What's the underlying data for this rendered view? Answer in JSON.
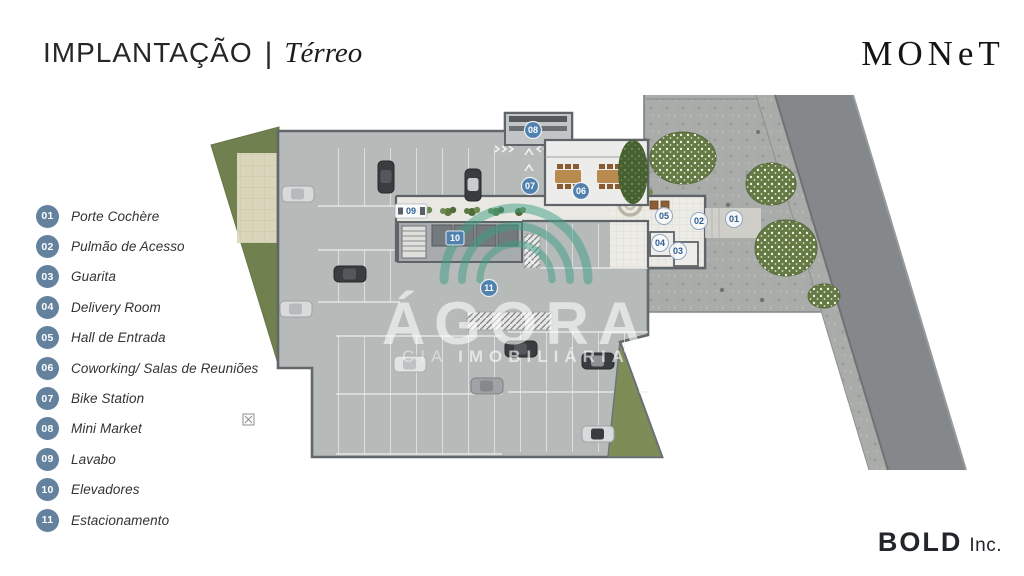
{
  "header": {
    "title": "IMPLANTAÇÃO",
    "separator": "|",
    "subtitle": "Térreo"
  },
  "brand": {
    "name": "MONeT"
  },
  "publisher": {
    "name": "BOLD",
    "suffix": "Inc."
  },
  "watermark": {
    "word": "ÁGORA",
    "tagline_thin": "CIA",
    "tagline_bold": "IMOBILIÁRIA",
    "arch_color": "#3da084"
  },
  "colors": {
    "legend_badge_blue": "#64829e",
    "marker_blue": "#5181ae",
    "marker_text_blue": "#2e6093",
    "green_dark": "#71804f",
    "green_light": "#7e8c58",
    "garage_floor": "#b6bab9",
    "wall_gray": "#60656a",
    "stone_plaza": "#a9aca9",
    "road_gray": "#85888b"
  },
  "legend": {
    "items": [
      {
        "num": "01",
        "label": "Porte Cochère"
      },
      {
        "num": "02",
        "label": "Pulmão de Acesso"
      },
      {
        "num": "03",
        "label": "Guarita"
      },
      {
        "num": "04",
        "label": "Delivery Room"
      },
      {
        "num": "05",
        "label": "Hall de Entrada"
      },
      {
        "num": "06",
        "label": "Coworking/ Salas de Reuniões"
      },
      {
        "num": "07",
        "label": "Bike Station"
      },
      {
        "num": "08",
        "label": "Mini Market"
      },
      {
        "num": "09",
        "label": "Lavabo"
      },
      {
        "num": "10",
        "label": "Elevadores"
      },
      {
        "num": "11",
        "label": "Estacionamento"
      }
    ]
  },
  "plan": {
    "markers": [
      {
        "num": "08",
        "x": 533,
        "y": 130,
        "variant": "blue"
      },
      {
        "num": "07",
        "x": 530,
        "y": 186,
        "variant": "blue"
      },
      {
        "num": "06",
        "x": 581,
        "y": 191,
        "variant": "blue"
      },
      {
        "num": "05",
        "x": 664,
        "y": 216,
        "variant": "light"
      },
      {
        "num": "02",
        "x": 699,
        "y": 221,
        "variant": "light"
      },
      {
        "num": "01",
        "x": 734,
        "y": 219,
        "variant": "light"
      },
      {
        "num": "04",
        "x": 660,
        "y": 243,
        "variant": "light"
      },
      {
        "num": "03",
        "x": 678,
        "y": 251,
        "variant": "light"
      },
      {
        "num": "09",
        "x": 411,
        "y": 211,
        "variant": "tag"
      },
      {
        "num": "10",
        "x": 455,
        "y": 238,
        "variant": "bluesq"
      },
      {
        "num": "11",
        "x": 489,
        "y": 288,
        "variant": "blue"
      }
    ]
  }
}
